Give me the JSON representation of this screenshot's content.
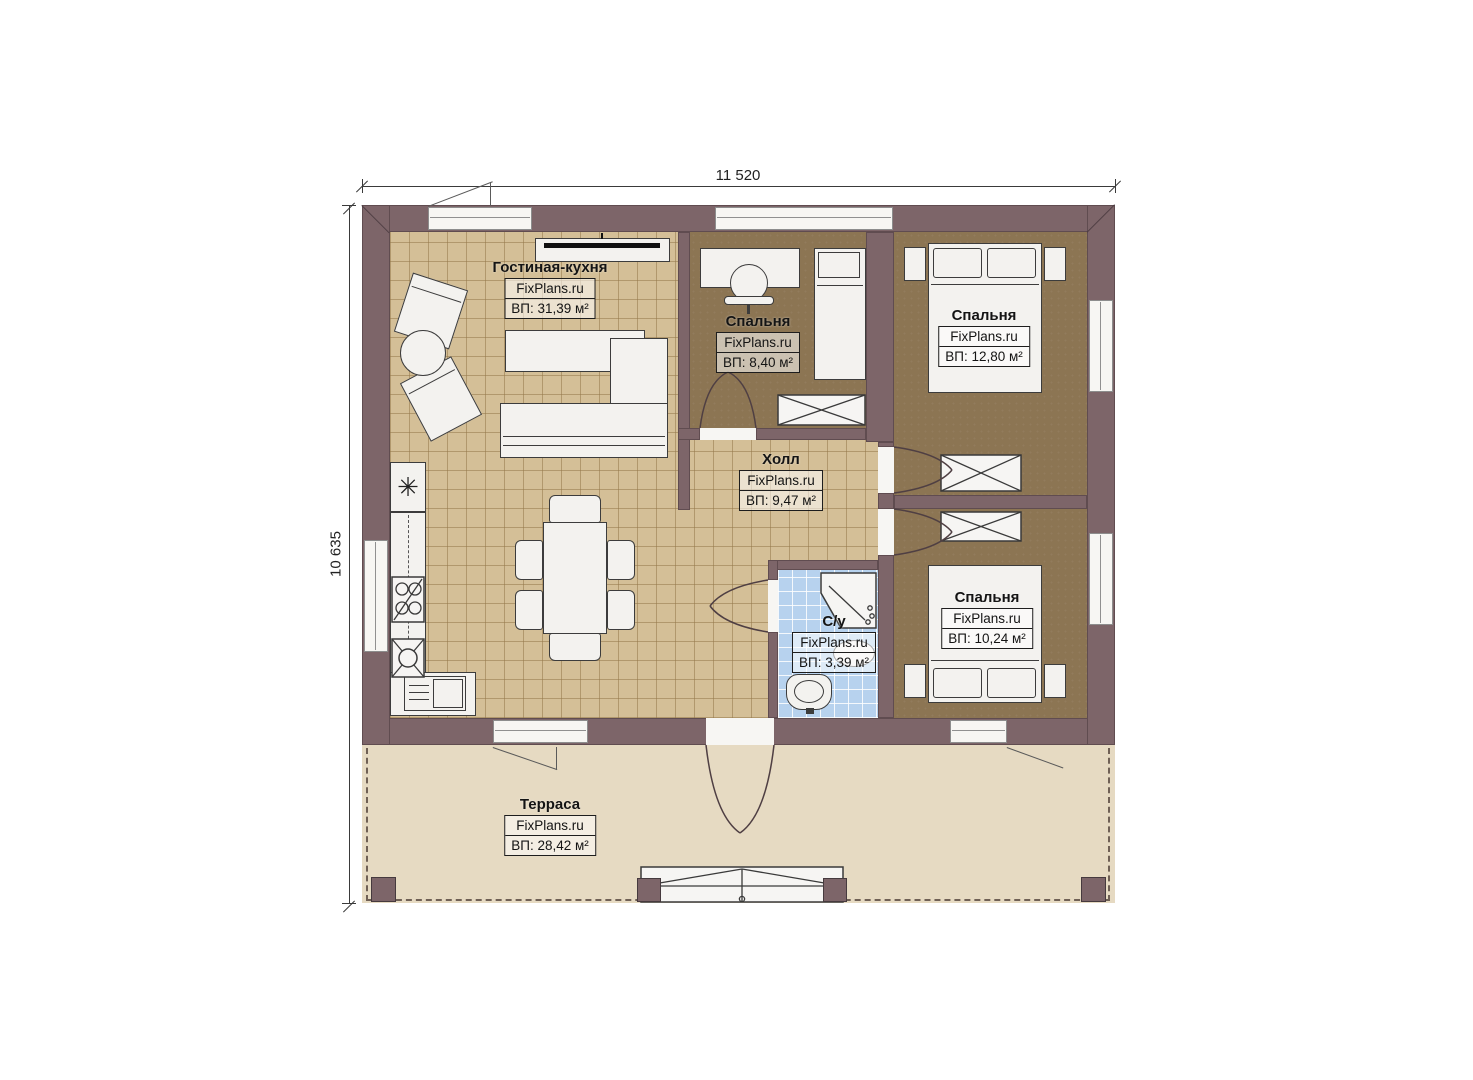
{
  "plan": {
    "dimensions": {
      "width_label": "11 520",
      "height_label": "10 635"
    },
    "rooms": [
      {
        "name": "Гостиная-кухня",
        "watermark": "FixPlans.ru",
        "area": "ВП: 31,39 м²"
      },
      {
        "name": "Спальня",
        "watermark": "FixPlans.ru",
        "area": "ВП: 8,40 м²"
      },
      {
        "name": "Спальня",
        "watermark": "FixPlans.ru",
        "area": "ВП: 12,80 м²"
      },
      {
        "name": "Холл",
        "watermark": "FixPlans.ru",
        "area": "ВП: 9,47 м²"
      },
      {
        "name": "С/у",
        "watermark": "FixPlans.ru",
        "area": "ВП: 3,39 м²"
      },
      {
        "name": "Спальня",
        "watermark": "FixPlans.ru",
        "area": "ВП: 10,24 м²"
      },
      {
        "name": "Терраса",
        "watermark": "FixPlans.ru",
        "area": "ВП: 28,42 м²"
      }
    ],
    "icons": {
      "fridge_symbol": "✳"
    },
    "colors": {
      "wall": "#7d6569",
      "floor_living": "#d4bf97",
      "floor_bedroom": "#8c7553",
      "floor_bathroom": "#b7d2ee",
      "floor_terrace": "#e6dac2",
      "furniture": "#f3f2ef",
      "outline": "#3c3c3c"
    }
  }
}
